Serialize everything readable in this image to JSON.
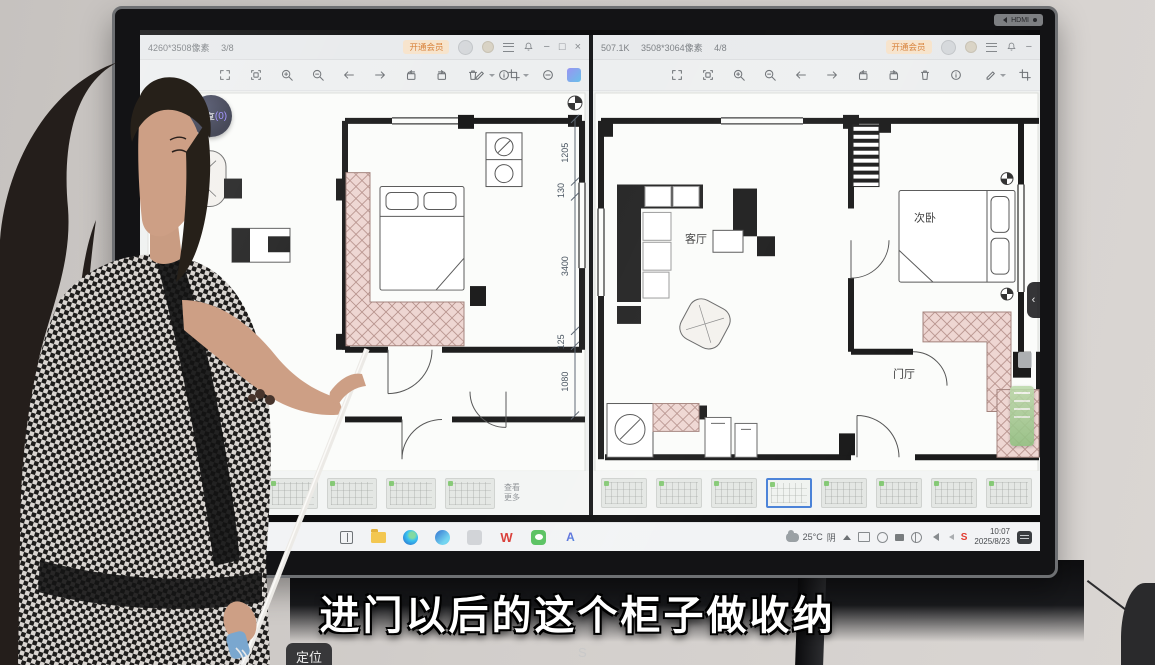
{
  "tv": {
    "bezel_label": "HDMI"
  },
  "left_window": {
    "resolution": "4260*3508像素",
    "page": "3/8",
    "vip": "开通会员",
    "badge_name": "飞享",
    "badge_count": "(0)",
    "more_line1": "查看",
    "more_line2": "更多",
    "thumb_count": 5
  },
  "right_window": {
    "filesize": "507.1K",
    "resolution": "3508*3064像素",
    "page": "4/8",
    "vip": "开通会员",
    "thumb_count": 8,
    "selected_thumb": 4
  },
  "window_controls": {
    "minimize": "−",
    "maximize": "□",
    "close": "×"
  },
  "toolbar_icons": [
    "fullscreen",
    "fit-screen",
    "zoom-in",
    "zoom-out",
    "previous",
    "next",
    "rotate-left",
    "rotate-right",
    "delete",
    "info",
    "annotate",
    "crop",
    "more",
    "ai-edit"
  ],
  "floorplan": {
    "left": {
      "dimensions": [
        "1205",
        "130",
        "3400",
        "125",
        "1080"
      ]
    },
    "right": {
      "rooms": {
        "living": "客厅",
        "bedroom": "次卧",
        "hall": "门厅"
      }
    }
  },
  "taskbar": {
    "weather_temp": "25°C",
    "weather_cond": "阴",
    "time": "10:07",
    "date": "2025/8/23",
    "wps_glyph": "W",
    "assistant_glyph": "A",
    "antivirus_glyph": "S",
    "apps": [
      "task-view",
      "file-explorer",
      "edge",
      "paint",
      "photoshop",
      "wps",
      "wechat",
      "ai-assistant"
    ],
    "tray": [
      "cast",
      "screen-record",
      "battery",
      "settings",
      "volume-mute",
      "volume",
      "antivirus"
    ]
  },
  "overlay": {
    "subtitle": "进门以后的这个柜子做收纳",
    "corner_badge": "定位",
    "watermark": "S"
  },
  "colors": {
    "vip_orange": "#d77f36",
    "selection_blue": "#4a82d8",
    "badge_purple": "#9b8bff",
    "hatch_pink": "#eed6d2"
  }
}
